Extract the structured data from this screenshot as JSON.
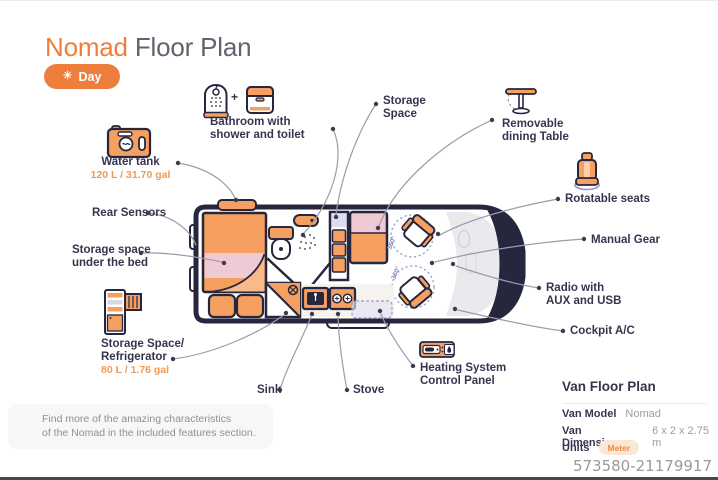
{
  "title": {
    "accent": "Nomad",
    "rest": " Floor Plan"
  },
  "day_button": {
    "label": "Day"
  },
  "features": {
    "bathroom": {
      "label": "Bathroom with\nshower and toilet",
      "joiner": "+"
    },
    "storage_space": {
      "label": "Storage\nSpace"
    },
    "dining_table": {
      "label": "Removable\ndining Table"
    },
    "water_tank": {
      "label": "Water tank",
      "value": "120 L / 31.70 gal"
    },
    "rear_sensors": {
      "label": "Rear Sensors"
    },
    "under_bed": {
      "label": "Storage space\nunder the bed"
    },
    "refrigerator": {
      "label": "Storage Space/\nRefrigerator",
      "value": "80 L / 1.76 gal"
    },
    "sink": {
      "label": "Sink"
    },
    "stove": {
      "label": "Stove"
    },
    "heating": {
      "label": "Heating System\nControl Panel"
    },
    "rotatable_seats": {
      "label": "Rotatable seats"
    },
    "manual_gear": {
      "label": "Manual Gear"
    },
    "radio": {
      "label": "Radio with\nAUX and USB"
    },
    "cockpit_ac": {
      "label": "Cockpit A/C"
    }
  },
  "plan": {
    "rotation_label": "360°"
  },
  "info_panel": {
    "title": "Van Floor Plan",
    "rows": [
      {
        "label": "Van Model",
        "value": "Nomad"
      },
      {
        "label": "Van Dimensions",
        "value": "6 x 2 x 2.75 m"
      },
      {
        "label": "Units",
        "value": "Meter"
      }
    ]
  },
  "note": "Find more of the amazing characteristics\nof the Nomad in the included features section.",
  "watermark": "573580-21179917",
  "colors": {
    "accent": "#EE7E3E",
    "navy": "#26263F",
    "furniture": "#F5A061",
    "pink": "#EFC9D4",
    "lavender": "#DDDDF2"
  }
}
